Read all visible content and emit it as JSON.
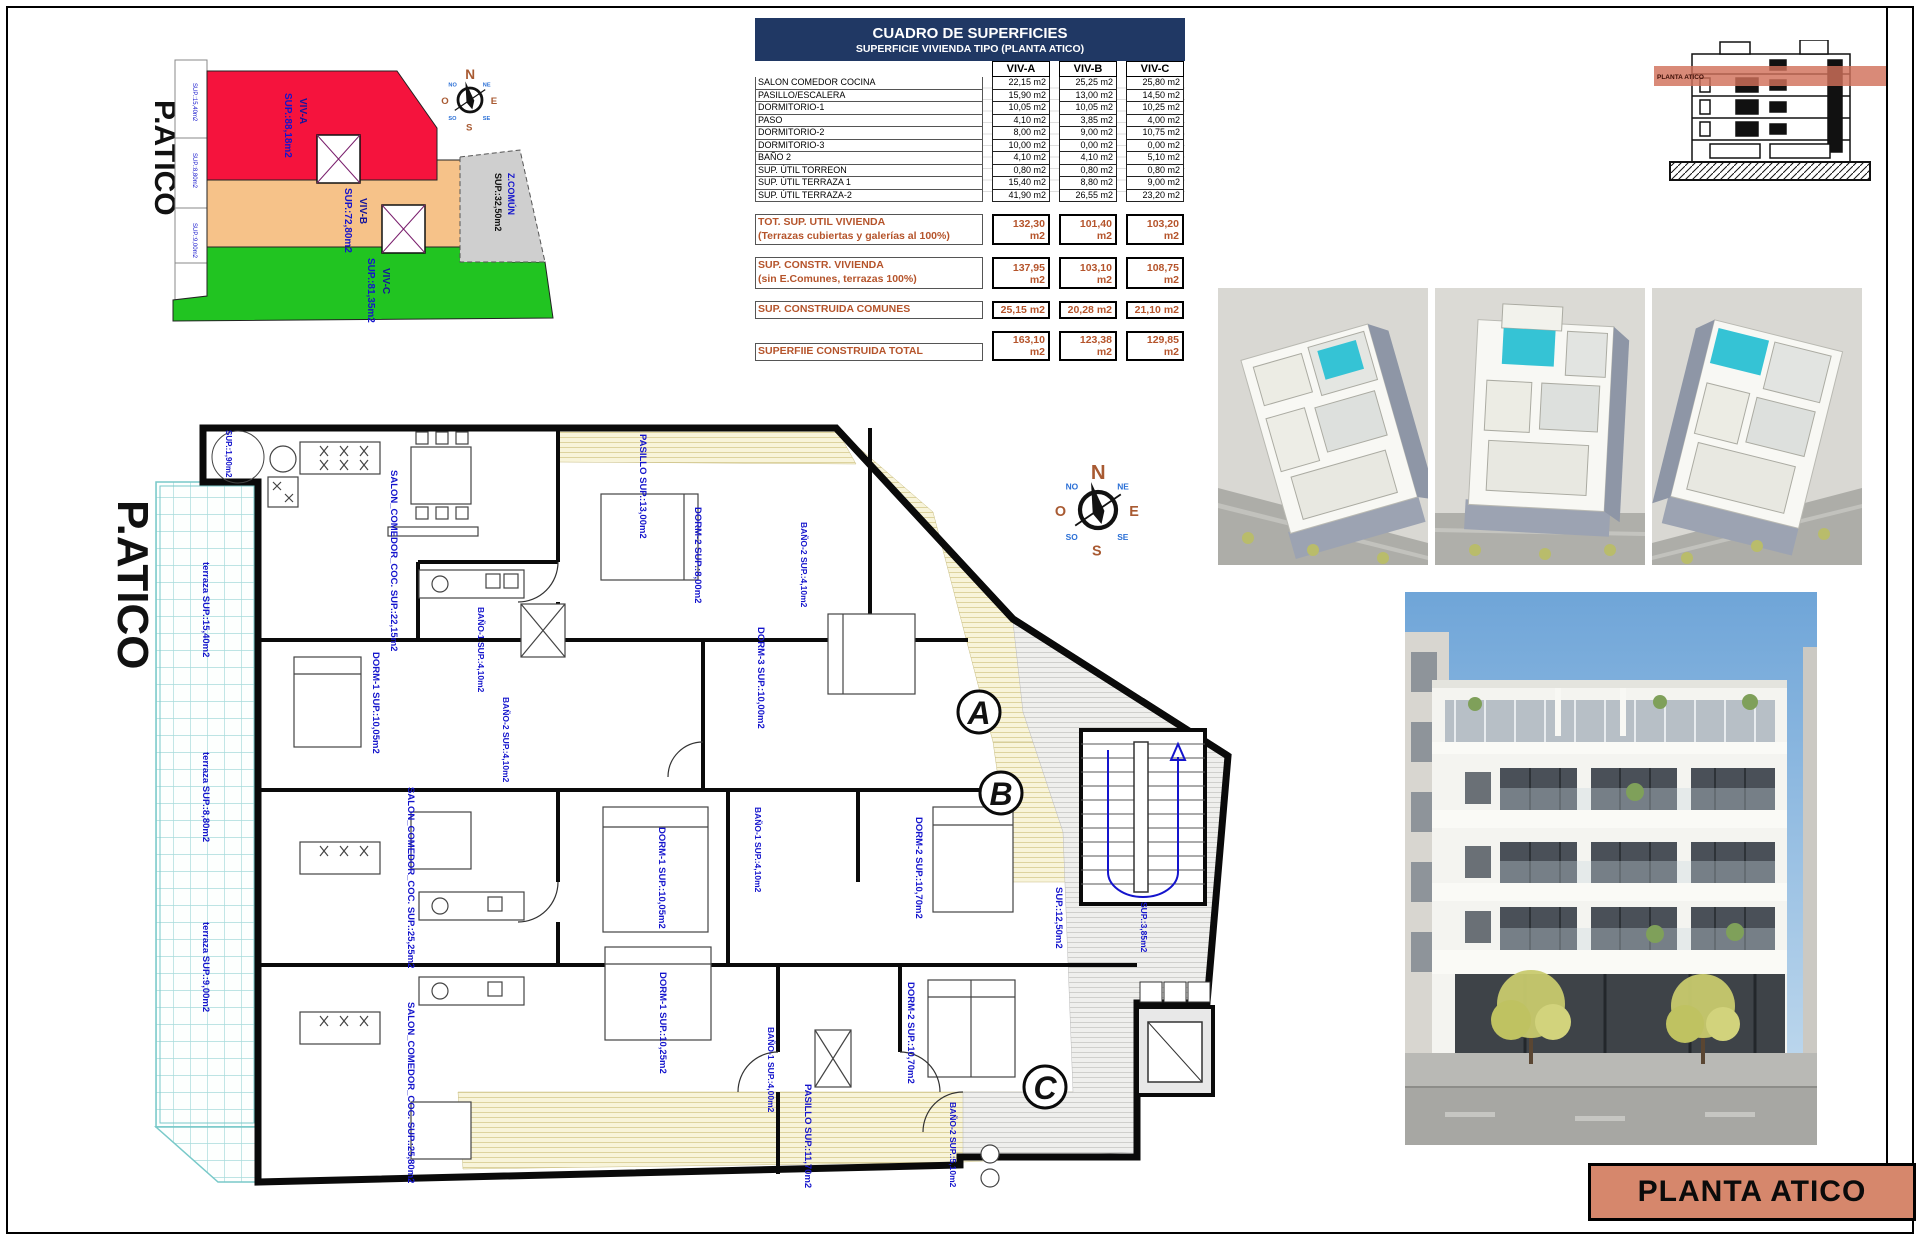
{
  "colors": {
    "header_navy": "#203864",
    "summary_orange": "#B5542B",
    "cad_blue": "#1414CC",
    "viv_a_red": "#F5133D",
    "viv_b_orange": "#F6C289",
    "viv_c_green": "#21C421",
    "comun_gray": "#CFCFCF",
    "salmon": "#D6876C",
    "pool_teal": "#35C3D5"
  },
  "table": {
    "title": "CUADRO DE SUPERFICIES",
    "subtitle": "SUPERFICIE VIVIENDA TIPO  (PLANTA ATICO)",
    "columns": [
      "VIV-A",
      "VIV-B",
      "VIV-C"
    ],
    "rows": [
      {
        "label": "SALON COMEDOR COCINA",
        "a": "22,15 m2",
        "b": "25,25 m2",
        "c": "25,80 m2"
      },
      {
        "label": "PASILLO/ESCALERA",
        "a": "15,90 m2",
        "b": "13,00 m2",
        "c": "14,50 m2"
      },
      {
        "label": "DORMITORIO-1",
        "a": "10,05 m2",
        "b": "10,05 m2",
        "c": "10,25 m2"
      },
      {
        "label": "PASO",
        "a": "4,10 m2",
        "b": "3,85 m2",
        "c": "4,00 m2"
      },
      {
        "label": "DORMITORIO-2",
        "a": "8,00 m2",
        "b": "9,00 m2",
        "c": "10,75 m2"
      },
      {
        "label": "DORMITORIO-3",
        "a": "10,00 m2",
        "b": "0,00 m2",
        "c": "0,00 m2"
      },
      {
        "label": "BAÑO 2",
        "a": "4,10 m2",
        "b": "4,10 m2",
        "c": "5,10 m2"
      },
      {
        "label": "SUP. ÚTIL TORREON",
        "a": "0,80 m2",
        "b": "0,80 m2",
        "c": "0,80 m2"
      },
      {
        "label": "SUP. ÚTIL TERRAZA 1",
        "a": "15,40 m2",
        "b": "8,80 m2",
        "c": "9,00 m2"
      },
      {
        "label": "SUP. ÚTIL TERRAZA-2",
        "a": "41,90 m2",
        "b": "26,55 m2",
        "c": "23,20 m2"
      }
    ],
    "summary": [
      {
        "label1": "TOT. SUP. UTIL VIVIENDA",
        "label2": "(Terrazas cubiertas y galerías al 100%)",
        "a": "132,30 m2",
        "b": "101,40 m2",
        "c": "103,20 m2"
      },
      {
        "label1": "SUP. CONSTR. VIVIENDA",
        "label2": "(sin E.Comunes, terrazas 100%)",
        "a": "137,95 m2",
        "b": "103,10 m2",
        "c": "108,75 m2"
      },
      {
        "label1": "SUP. CONSTRUIDA COMUNES",
        "label2": "",
        "a": "25,15 m2",
        "b": "20,28 m2",
        "c": "21,10 m2"
      },
      {
        "label1": "SUPERFIIE CONSTRUIDA TOTAL",
        "label2": "",
        "a": "163,10 m2",
        "b": "123,38 m2",
        "c": "129,85 m2"
      }
    ]
  },
  "site_plan": {
    "title": "P.ATICO",
    "units": [
      {
        "name": "VIV-A",
        "area": "SUP.:88,18m2"
      },
      {
        "name": "VIV-B",
        "area": "SUP.:72,80m2"
      },
      {
        "name": "VIV-C",
        "area": "SUP.:81,35m2"
      }
    ],
    "common": {
      "name": "Z.COMÚN",
      "area": "SUP.:32,50m2"
    },
    "edge_labels": [
      "SUP.:15,40m2",
      "SUP.:8,80m2",
      "SUP.:9,00m2"
    ]
  },
  "compass": {
    "n": "N",
    "s": "S",
    "e": "E",
    "o": "O",
    "ne": "NE",
    "no": "NO",
    "se": "SE",
    "so": "SO"
  },
  "section": {
    "band_label": "PLANTA ATICO"
  },
  "plan": {
    "title": "P.ATICO",
    "marks": {
      "a": "A",
      "b": "B",
      "c": "C"
    },
    "labels": [
      {
        "t": "SALON_COMEDOR_COC. SUP.:22,15m2"
      },
      {
        "t": "terraza SUP.:15,40m2"
      },
      {
        "t": "SUP.:1,90m2"
      },
      {
        "t": "DORM-1 SUP.:10,05m2"
      },
      {
        "t": "BAÑO-1 SUP.:4,10m2"
      },
      {
        "t": "BAÑO-2 SUP.:4,10m2"
      },
      {
        "t": "PASILLO SUP.:13,00m2"
      },
      {
        "t": "DORM-2 SUP.:8,00m2"
      },
      {
        "t": "BAÑO-2 SUP.:4,10m2"
      },
      {
        "t": "DORM-3 SUP.:10,00m2"
      },
      {
        "t": "SUP.:12,50m2"
      },
      {
        "t": "SUP.:3,85m2"
      },
      {
        "t": "SALON_COMEDOR_COC. SUP.:25,25m2"
      },
      {
        "t": "DORM-1 SUP.:10,05m2"
      },
      {
        "t": "BAÑO-1 SUP.:4,10m2"
      },
      {
        "t": "DORM-2 SUP.:10,70m2"
      },
      {
        "t": "terraza SUP.:8,80m2"
      },
      {
        "t": "SALON_COMEDOR_COC. SUP.:25,80m2"
      },
      {
        "t": "DORM-1 SUP.:10,25m2"
      },
      {
        "t": "BAÑO-1 SUP.:4,00m2"
      },
      {
        "t": "DORM-2 SUP.:10,70m2"
      },
      {
        "t": "PASILLO SUP.:11,70m2"
      },
      {
        "t": "terraza SUP.:9,00m2"
      },
      {
        "t": "BAÑO-2 SUP.:5,10m2"
      }
    ]
  },
  "title_block": {
    "label": "PLANTA ATICO"
  }
}
